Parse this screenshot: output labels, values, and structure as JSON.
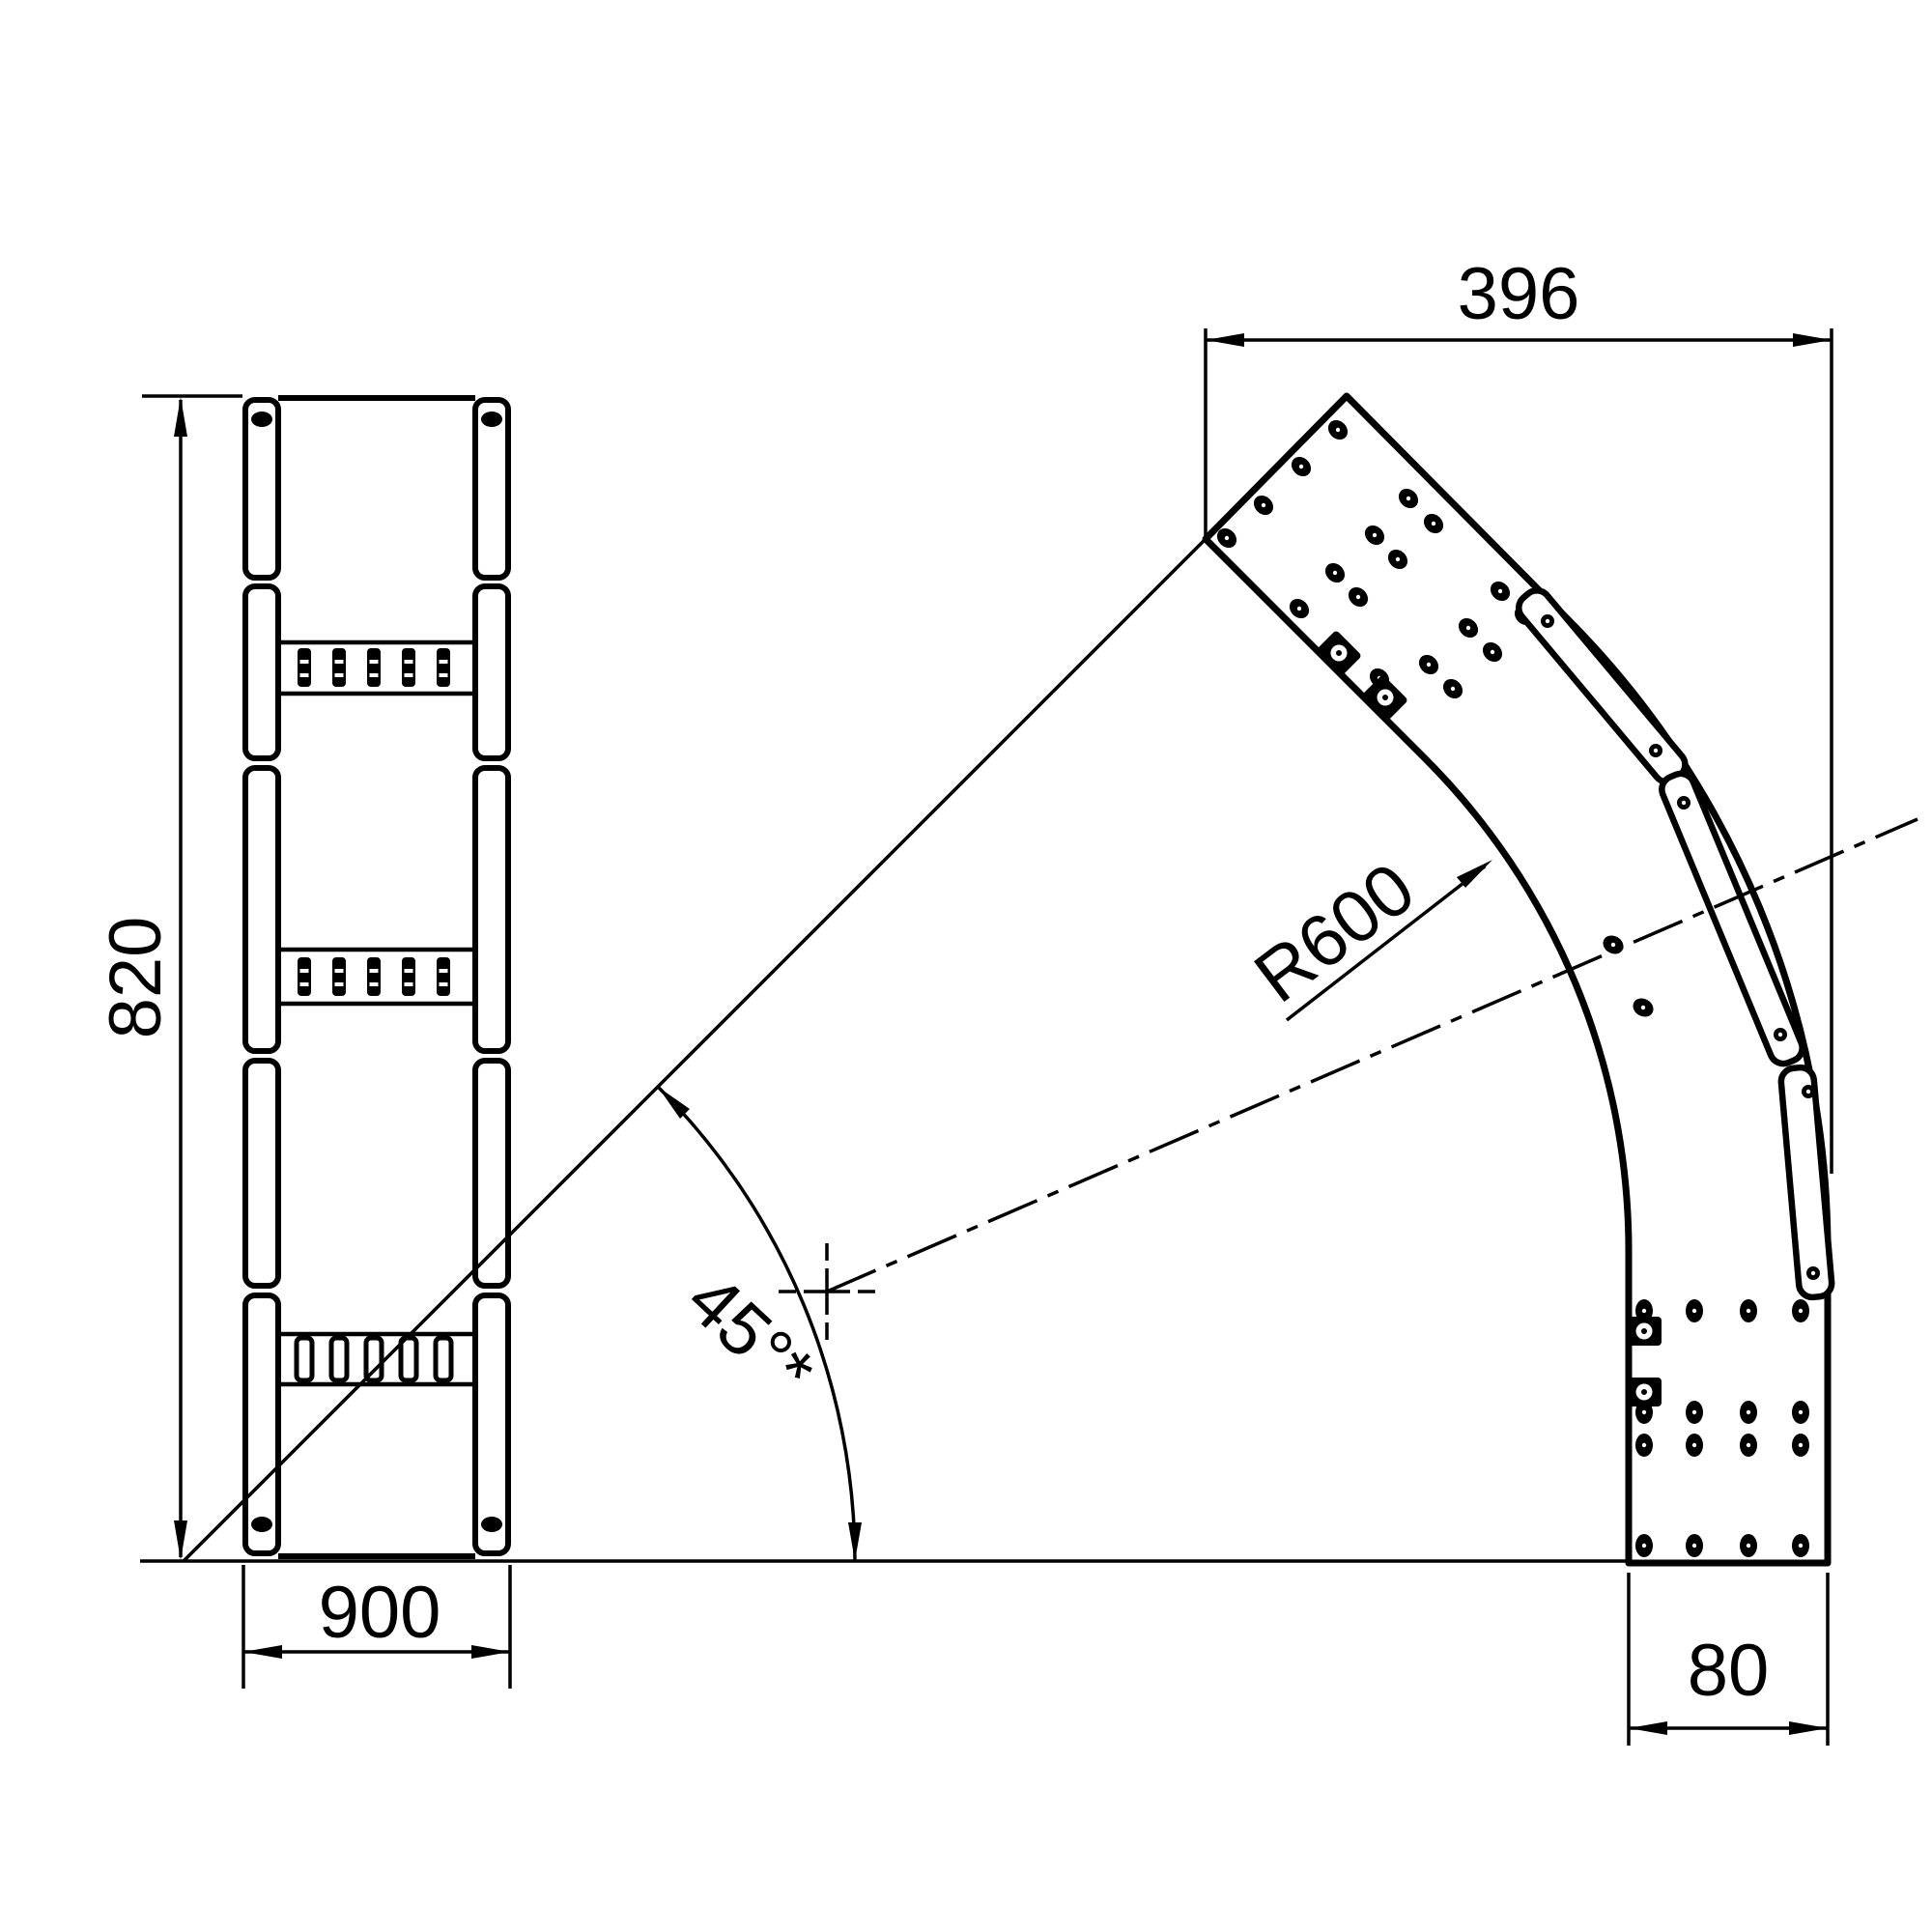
{
  "drawing": {
    "type": "technical-drawing",
    "views": {
      "left_view": {
        "description_labels": {
          "height_dimension": "820",
          "width_dimension": "900"
        }
      },
      "right_view": {
        "description_labels": {
          "top_width_dimension": "396",
          "radius_dimension": "R600",
          "angle_dimension": "45°*",
          "bottom_width_dimension": "80"
        }
      }
    },
    "colors": {
      "line": "#000000",
      "background": "#ffffff"
    }
  }
}
